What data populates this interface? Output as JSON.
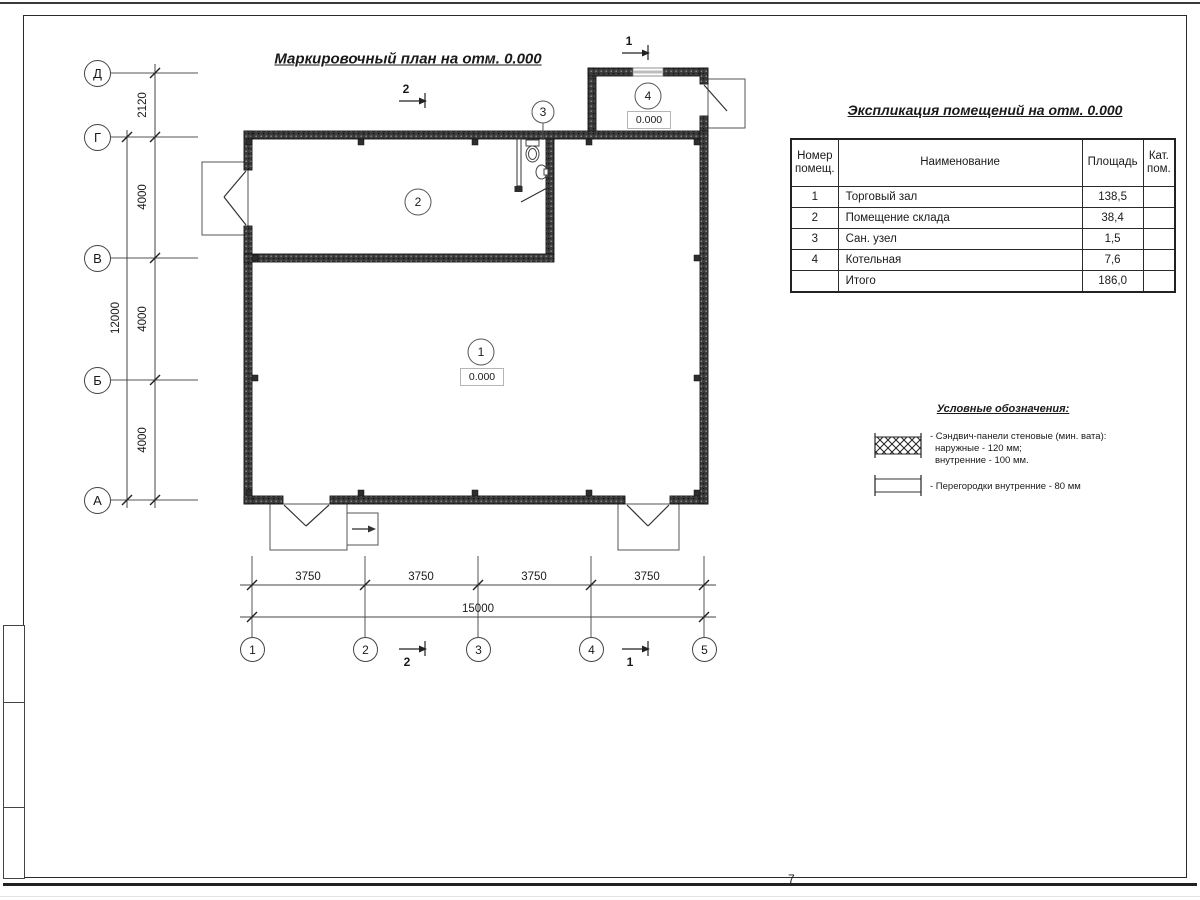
{
  "sheet": {
    "plan_title": "Маркировочный план на отм. 0.000",
    "page_mark": "7"
  },
  "plan": {
    "axes": {
      "rows": [
        "Д",
        "Г",
        "В",
        "Б",
        "А"
      ],
      "cols": [
        "1",
        "2",
        "3",
        "4",
        "5"
      ]
    },
    "dims": {
      "left": [
        "2120",
        "4000",
        "4000",
        "4000"
      ],
      "left_total": "12000",
      "bottom": [
        "3750",
        "3750",
        "3750",
        "3750"
      ],
      "bottom_total": "15000"
    },
    "rooms": [
      {
        "number": "1",
        "elevation": "0.000"
      },
      {
        "number": "2"
      },
      {
        "number": "3"
      },
      {
        "number": "4",
        "elevation": "0.000"
      }
    ],
    "sections": {
      "top_left": "2",
      "top_right": "1",
      "bottom_left": "2",
      "bottom_right": "1"
    }
  },
  "table": {
    "title": "Экспликация помещений на отм. 0.000",
    "headers": {
      "number": "Номер помещ.",
      "name": "Наименование",
      "area": "Площадь",
      "cat": "Кат. пом."
    },
    "rows": [
      {
        "number": "1",
        "name": "Торговый зал",
        "area": "138,5",
        "cat": ""
      },
      {
        "number": "2",
        "name": "Помещение склада",
        "area": "38,4",
        "cat": ""
      },
      {
        "number": "3",
        "name": "Сан. узел",
        "area": "1,5",
        "cat": ""
      },
      {
        "number": "4",
        "name": "Котельная",
        "area": "7,6",
        "cat": ""
      },
      {
        "number": "",
        "name": "Итого",
        "area": "186,0",
        "cat": ""
      }
    ]
  },
  "legend": {
    "title": "Условные обозначения:",
    "items": [
      {
        "icon": "sandwich-panel-hatch-icon",
        "lines": [
          "- Сэндвич-панели стеновые (мин. вата):",
          "наружные - 120 мм;",
          "внутренние - 100 мм."
        ]
      },
      {
        "icon": "partition-symbol-icon",
        "lines": [
          "- Перегородки внутренние - 80 мм"
        ]
      }
    ]
  }
}
